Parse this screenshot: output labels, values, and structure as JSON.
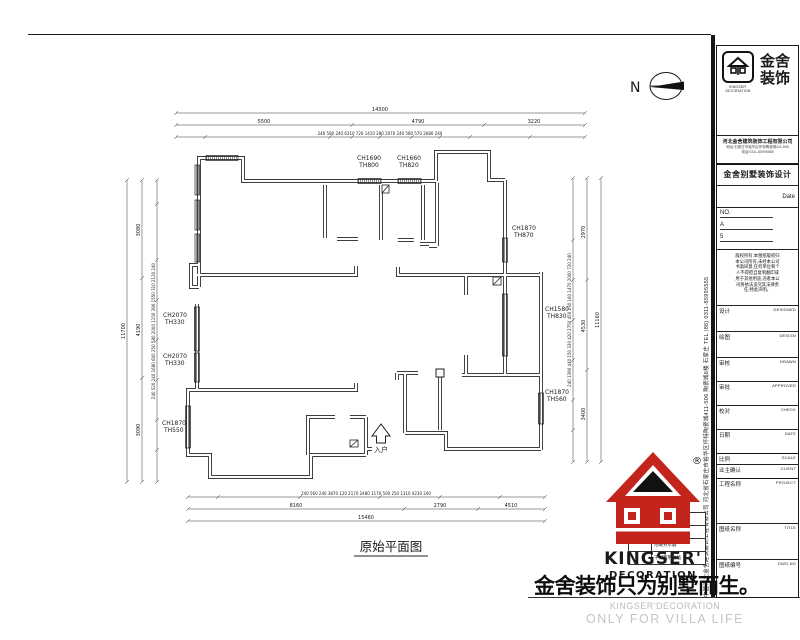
{
  "frame": {
    "north_label": "N"
  },
  "plan": {
    "title": "原始平面图",
    "entry_label": "入户",
    "windows": [
      {
        "l1": "CH1690",
        "l2": "TH800"
      },
      {
        "l1": "CH1660",
        "l2": "TH820"
      },
      {
        "l1": "CH1870",
        "l2": "TH870"
      },
      {
        "l1": "CH1580",
        "l2": "TH830"
      },
      {
        "l1": "CH1870",
        "l2": "TH560"
      },
      {
        "l1": "CH2070",
        "l2": "TH330"
      },
      {
        "l1": "CH2070",
        "l2": "TH330"
      },
      {
        "l1": "CH1870",
        "l2": "TH550"
      }
    ]
  },
  "dims": {
    "top_total": "14300",
    "top_mid": [
      "5500",
      "4790",
      "3220"
    ],
    "top_detail": "240 580 240   6310   720  1410  280 2070 240 580  570   2680  240",
    "bottom_detail": "240 560 240   3870   120  2170   2480  1170 500 250  1310    4230   240",
    "bottom_mid": [
      "8160",
      "2790",
      "4510"
    ],
    "bottom_total": "15460",
    "left_total": "11700",
    "left_mid": [
      "3080",
      "4190",
      "3090"
    ],
    "left_detail": "240 520 240 1680 600 250 580 2000 1150 390 1550 310 2120 240",
    "right_total": "11160",
    "right_mid": [
      "2970",
      "4530",
      "3400"
    ],
    "right_detail": "240 1390 440 150 330 420 2750 450 230 160 1470 2000 720 240"
  },
  "titleblock": {
    "brand_cn_1": "金舍",
    "brand_cn_2": "装饰",
    "brand_en_1": "KINGSER'",
    "brand_en_2": "DECORATION",
    "company": "河北金舍建筑装饰工程有限公司",
    "address_line1": "地址:石家庄市裕华区怀特陶瓷城411-506",
    "address_line2": "电话:0311-85995555",
    "dept_title": "金舍别墅装饰设计",
    "date_label": "Date",
    "no_label": "NO.",
    "no_item_1": "A",
    "no_item_2": "5",
    "note_lines": [
      "版权所有:本图纸版权归",
      "本公司所有,未经本公司",
      "书面同意,任何单位和个",
      "人不得擅自复制翻印或",
      "用于其他用途,违者本公",
      "司将依法追究其法律责",
      "任,特此声明。"
    ],
    "rows": [
      {
        "zh": "设计",
        "en": "DESIGNED"
      },
      {
        "zh": "绘图",
        "en": "DESIGN"
      },
      {
        "zh": "审核",
        "en": "DRAWN"
      },
      {
        "zh": "审批",
        "en": "APPROVED"
      },
      {
        "zh": "校对",
        "en": "CHECK"
      },
      {
        "zh": "日期",
        "en": "DATE"
      },
      {
        "zh": "比例",
        "en": "SCALE"
      },
      {
        "zh": "业主确认",
        "en": "CLIENT"
      },
      {
        "zh": "工程名称",
        "en": "PROJECT"
      },
      {
        "zh": "图纸名称",
        "en": "TITLE"
      },
      {
        "zh": "图纸编号",
        "en": "DWG.NO"
      }
    ],
    "side_text": "中国河北金舍建筑装饰工程有限公司  河北省石家庄市裕华区怀特陶瓷城411-506 陶瓷城6楼   石家庄 TEL (86) 0311-85995555"
  },
  "legend": {
    "rows": [
      "",
      "",
      "地暖分水器",
      "干湿两用地插"
    ]
  },
  "logo_red": {
    "reg": "®",
    "text1": "KINGSER'",
    "text2": "DECORATION"
  },
  "footer": {
    "slogan": "金舍装饰只为别墅而生。",
    "en1": "KINGSER'DECORATION",
    "en2": "ONLY FOR VILLA LIFE"
  },
  "colors": {
    "line": "#2a2a2a",
    "red": "#c3241c",
    "gray": "#bdbdbd"
  }
}
